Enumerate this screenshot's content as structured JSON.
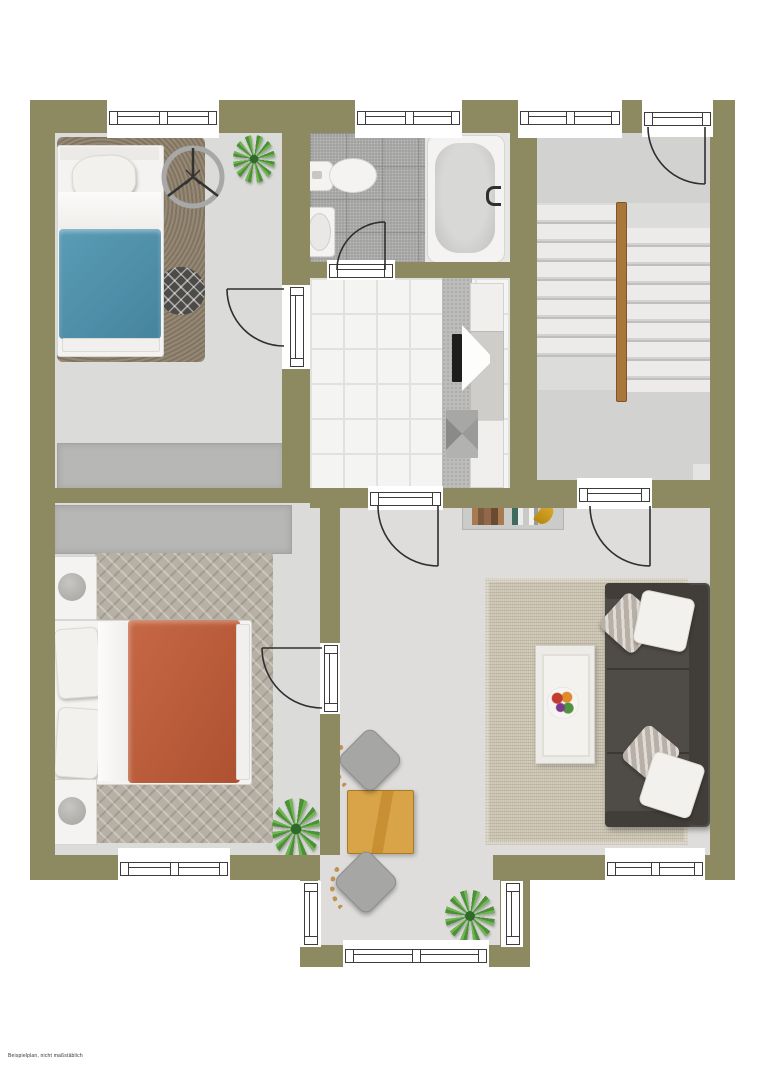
{
  "caption": "Beispielplan, nicht maßstäblich",
  "plan": {
    "type": "floor-plan",
    "view": "top-down, furnished, no room labels",
    "rooms": [
      {
        "name": "bedroom-top-left",
        "furniture": [
          "single-bed-blue",
          "shag-rug",
          "round-patterned-rug",
          "ceiling-fan",
          "plant",
          "wardrobe"
        ]
      },
      {
        "name": "bathroom",
        "furniture": [
          "toilet",
          "washbasin",
          "bathtub"
        ]
      },
      {
        "name": "stairwell",
        "furniture": [
          "double-flight-staircase",
          "wood-handrail",
          "entry-door"
        ]
      },
      {
        "name": "utility-room-tiled",
        "furniture": [
          "sideboard-top",
          "tv",
          "sideboard-bottom",
          "pyramid-object"
        ]
      },
      {
        "name": "bedroom-bottom-left",
        "furniture": [
          "double-bed-orange",
          "nightstand-lamp-top",
          "nightstand-lamp-bottom",
          "herringbone-rug",
          "wardrobe",
          "plant"
        ]
      },
      {
        "name": "living-dining",
        "furniture": [
          "sofa-3-seat",
          "cushions",
          "coffee-table",
          "fruit-bowl",
          "area-rug",
          "bookshelf",
          "dining-table",
          "dining-chair-top",
          "dining-chair-bottom",
          "plant"
        ]
      }
    ],
    "counts": {
      "windows": 9,
      "doors": 6,
      "plants": 3
    }
  },
  "palette": {
    "wall": "#8d8a62",
    "floor": "#dbdbd9",
    "bath_tile": "#a3a3a1",
    "white_tile": "#f4f4f2",
    "bed_blue": "#4f93ad",
    "bed_orange": "#c05f3c",
    "sofa": "#4f4b47",
    "table_wood": "#d9a348",
    "stair_rail": "#a9763b",
    "plant_green": "#4c9038",
    "rug_living": "#cac2b0",
    "rug_shag": "#8b7d69"
  }
}
